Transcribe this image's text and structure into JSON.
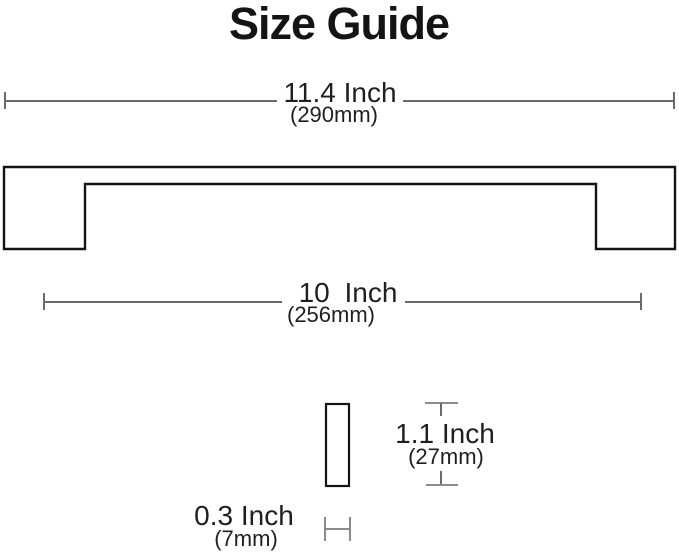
{
  "title": "Size Guide",
  "colors": {
    "background": "#ffffff",
    "text": "#1f1f1f",
    "dimension_line": "#6a6a6a",
    "small_tick": "#8c8c8c",
    "shape_outline": "#141414"
  },
  "product": {
    "name": "cabinet-pull-handle",
    "views": [
      "front-profile",
      "side-cross-section"
    ]
  },
  "dimensions": {
    "overall_length": {
      "label_inch": "11.4 Inch",
      "label_mm": "(290mm)"
    },
    "hole_center_to_center": {
      "label_inch": "10 Inch",
      "label_mm": "(256mm)"
    },
    "height": {
      "label_inch": "1.1 Inch",
      "label_mm": "(27mm)"
    },
    "thickness": {
      "label_inch": "0.3 Inch",
      "label_mm": "(7mm)"
    }
  }
}
